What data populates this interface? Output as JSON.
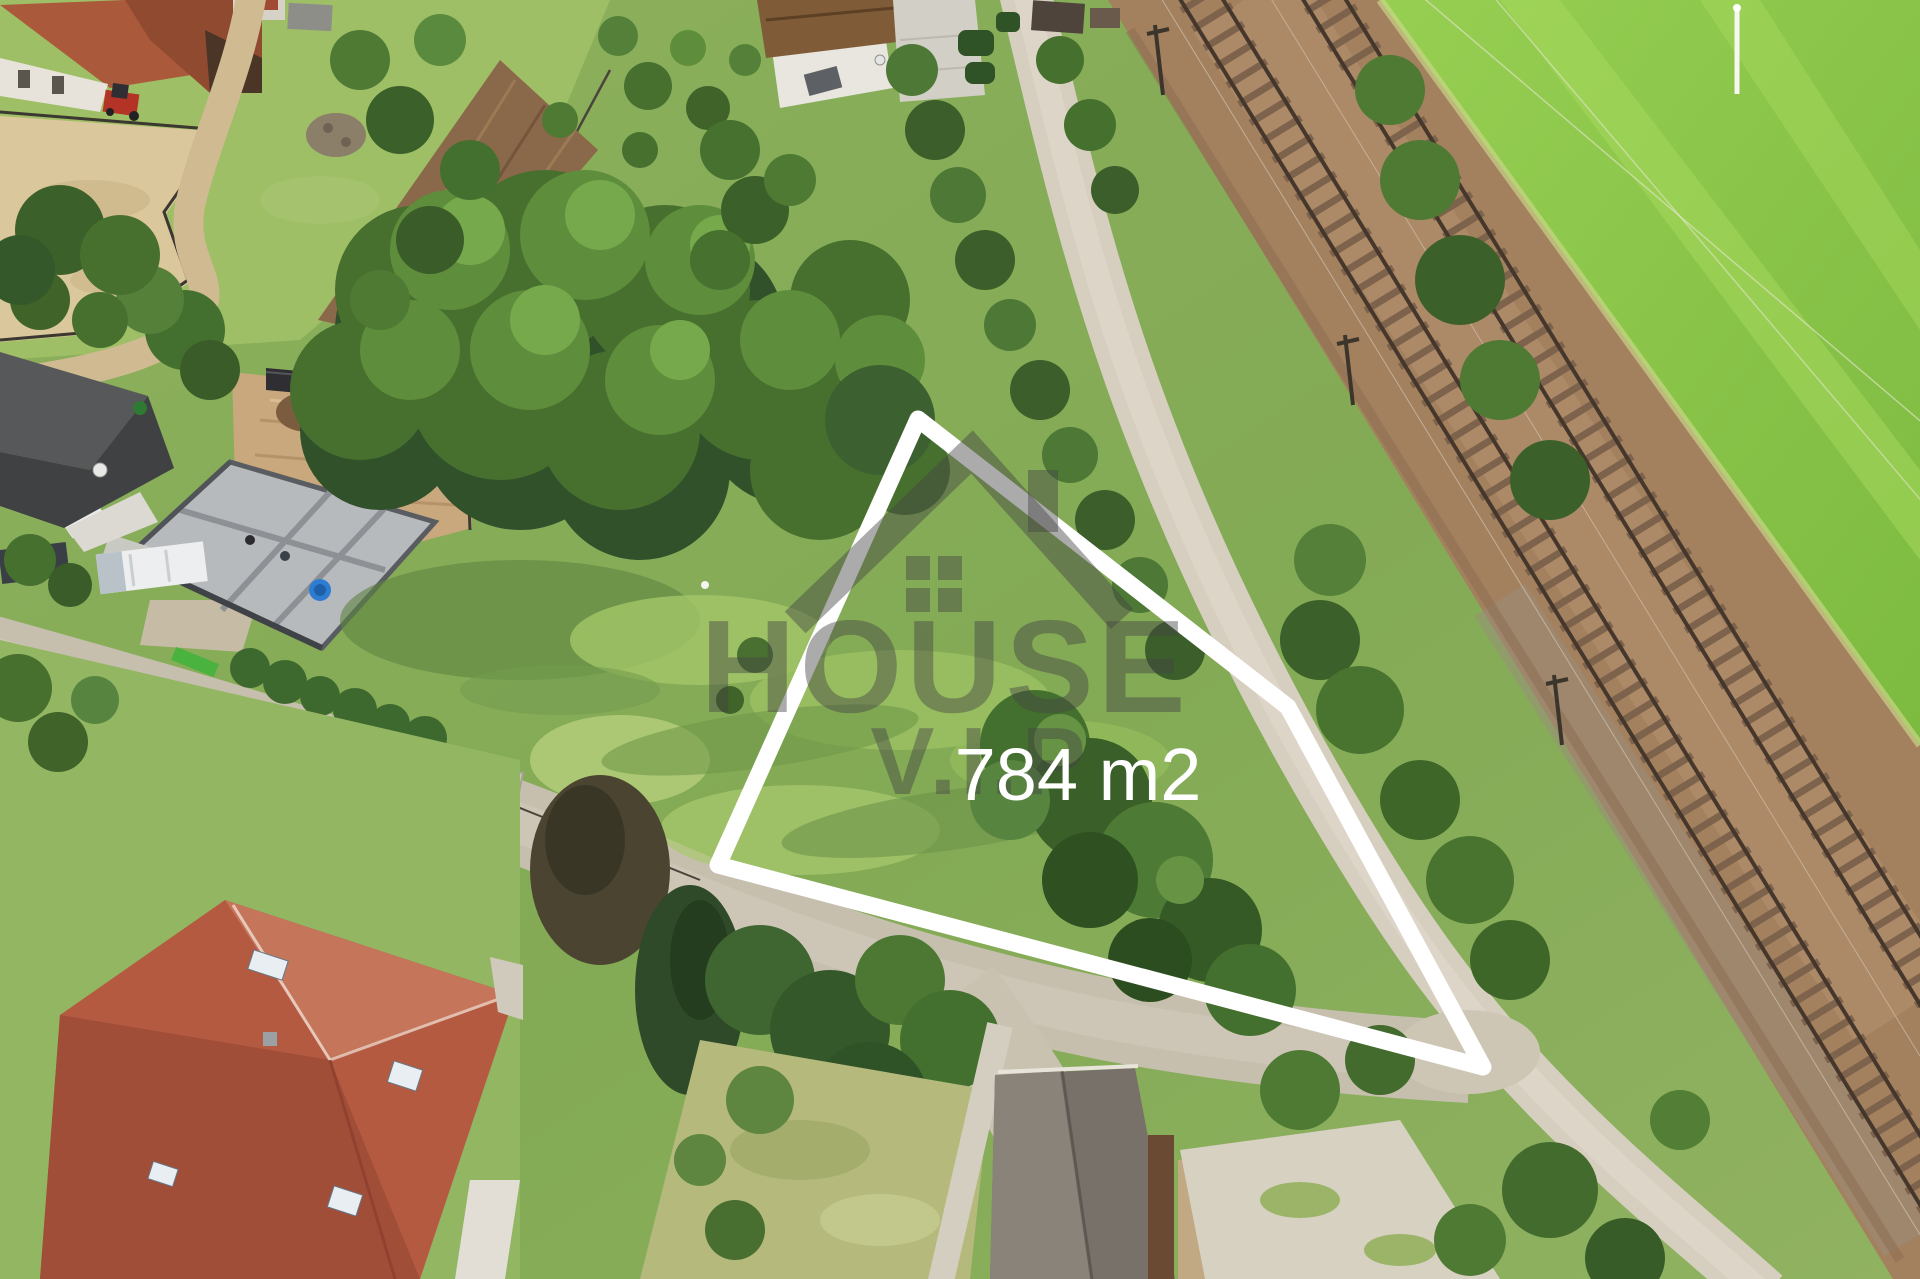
{
  "image": {
    "type": "aerial-drone-photograph",
    "description": "Aerial drone view of a building plot for sale bordered by a rural road and a double-track railway, with farm, construction site and family houses around it"
  },
  "overlay": {
    "area_label": "784 m2",
    "watermark": {
      "line1": "HOUSE",
      "line2": "V.I.P"
    },
    "plot_points": "918,419 1288,707 1483,1067 718,865",
    "outline_color": "#ffffff",
    "label_color": "#ffffff",
    "watermark_color": "rgba(68,68,68,0.45)"
  },
  "scene": {
    "meadow_color": "#86ad5a",
    "bright_field_color": "#8ec74b",
    "railway_ballast_color": "#a3815f",
    "road_color": "#c6bfae",
    "farm_roof_color": "#a85a3c",
    "red_house_roof_color": "#b45a41",
    "construction_dirt_color": "#c9a87d"
  }
}
